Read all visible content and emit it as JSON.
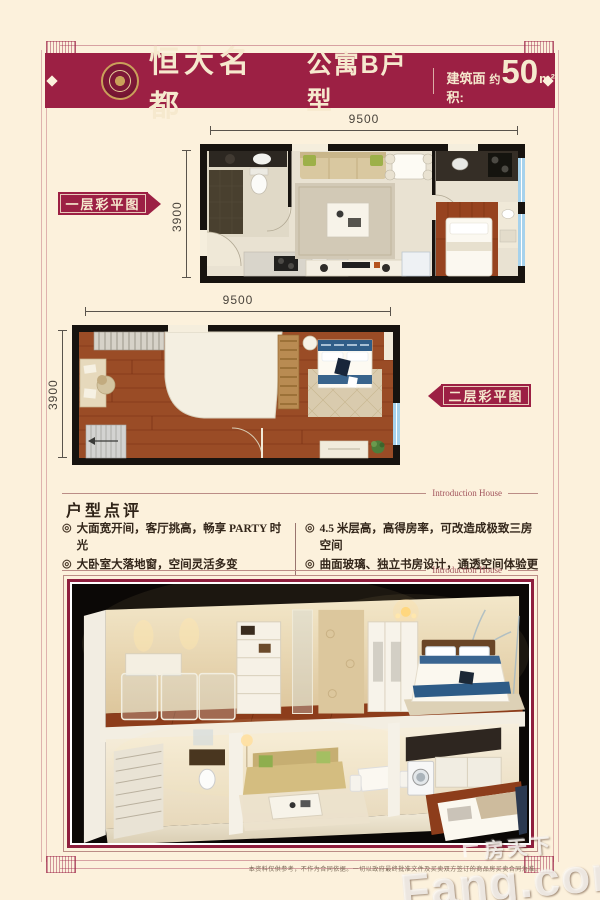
{
  "header": {
    "brand": "恒大名都",
    "title": "公寓B户型",
    "area_prefix": "建筑面积:",
    "area_approx": "约",
    "area_value": "50",
    "area_unit": "m²"
  },
  "plans": [
    {
      "label": "一层彩平图",
      "width_dim": "9500",
      "height_dim": "3900"
    },
    {
      "label": "二层彩平图",
      "width_dim": "9500",
      "height_dim": "3900"
    }
  ],
  "review": {
    "title": "户型点评",
    "divider_caption": "Introduction House",
    "bullet": "◎",
    "left_points": [
      "大面宽开间，客厅挑高，畅享 PARTY 时光",
      "大卧室大落地窗，空间灵活多变"
    ],
    "right_points": [
      "4.5 米层高，高得房率，可改造成极致三房空间",
      "曲面玻璃、独立书房设计，通透空间体验更佳"
    ]
  },
  "footer": {
    "disclaimer": "本资料仅供参考，不作为合同依据。一切以政府最终批准文件及买卖双方签订的商品房买卖合同为准。",
    "watermark_cn": "房天下",
    "watermark_en": "Fang.com"
  },
  "colors": {
    "brand_maroon": "#9c2044",
    "page_cream": "#fcf1dc",
    "window_blue": "#a6d2ec",
    "wood_floor": "#9a4c26"
  }
}
